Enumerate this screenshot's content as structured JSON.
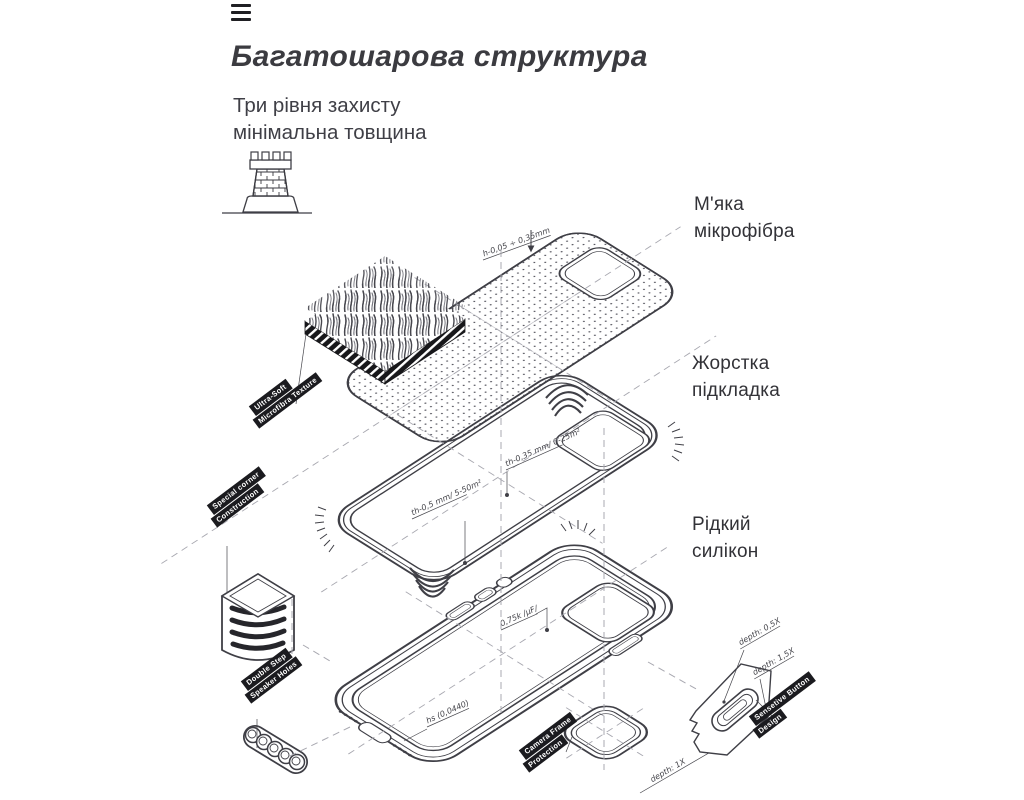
{
  "header": {
    "title": "Багатошарова структура",
    "subtitle": "Три рівня захисту\nмінімальна товщина"
  },
  "labels": {
    "layer1": "М'яка\nмікрофібра",
    "layer2": "Жорстка\nпідкладка",
    "layer3": "Рідкий\nсилікон"
  },
  "diagram": {
    "dimension_top": "h-0,05 ÷ 0,35mm",
    "shell_note_center": "th-0,5 mm/ 5-50m²",
    "shell_note_camera": "th-0,35 mm/ 0-25m²",
    "case_note_buttons": "0,75k /µF/",
    "case_note_bottom": "hs (0,0440)",
    "button_depth_1": "depth: 0,5X",
    "button_depth_2": "depth: 1,5X",
    "ring_depth": "depth: 1X",
    "tags": {
      "microfiber": [
        "Ultra-Soft",
        "Microfibra Texture"
      ],
      "corner": [
        "Special corner",
        "Construction"
      ],
      "speaker": [
        "Double Step",
        "Speaker Holes"
      ],
      "camera": [
        "Camera Frame",
        "Protection"
      ],
      "button": [
        "Sensetive Button",
        "Design"
      ]
    }
  },
  "colors": {
    "line": "#3f3f46",
    "dash": "#a8a8b0",
    "tag_bg": "#1b1b1f",
    "text": "#3a3a40"
  }
}
